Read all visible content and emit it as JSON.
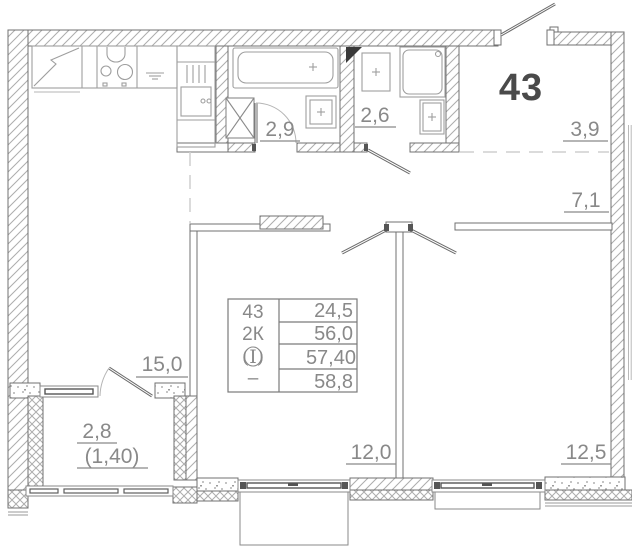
{
  "plan": {
    "apartment_number": "43",
    "room_areas": {
      "bathroom": "2,9",
      "wc": "2,6",
      "entry_hall": "3,9",
      "hallway": "7,1",
      "kitchen_living": "15,0",
      "balcony_full": "2,8",
      "balcony_reduced": "(1,40)",
      "bedroom_left": "12,0",
      "bedroom_right": "12,5"
    },
    "stamp": {
      "apartment_number": "43",
      "type": "2К",
      "category_symbol": "(I)",
      "dash": "–",
      "rows": [
        "24,5",
        "56,0",
        "57,40",
        "58,8"
      ]
    },
    "colors": {
      "wall_outline": "#707070",
      "hatch": "#adadad",
      "fixture": "#9e9e9e",
      "label": "#898989",
      "apartment_number_dark": "#4a4a4a",
      "background": "#ffffff"
    }
  }
}
